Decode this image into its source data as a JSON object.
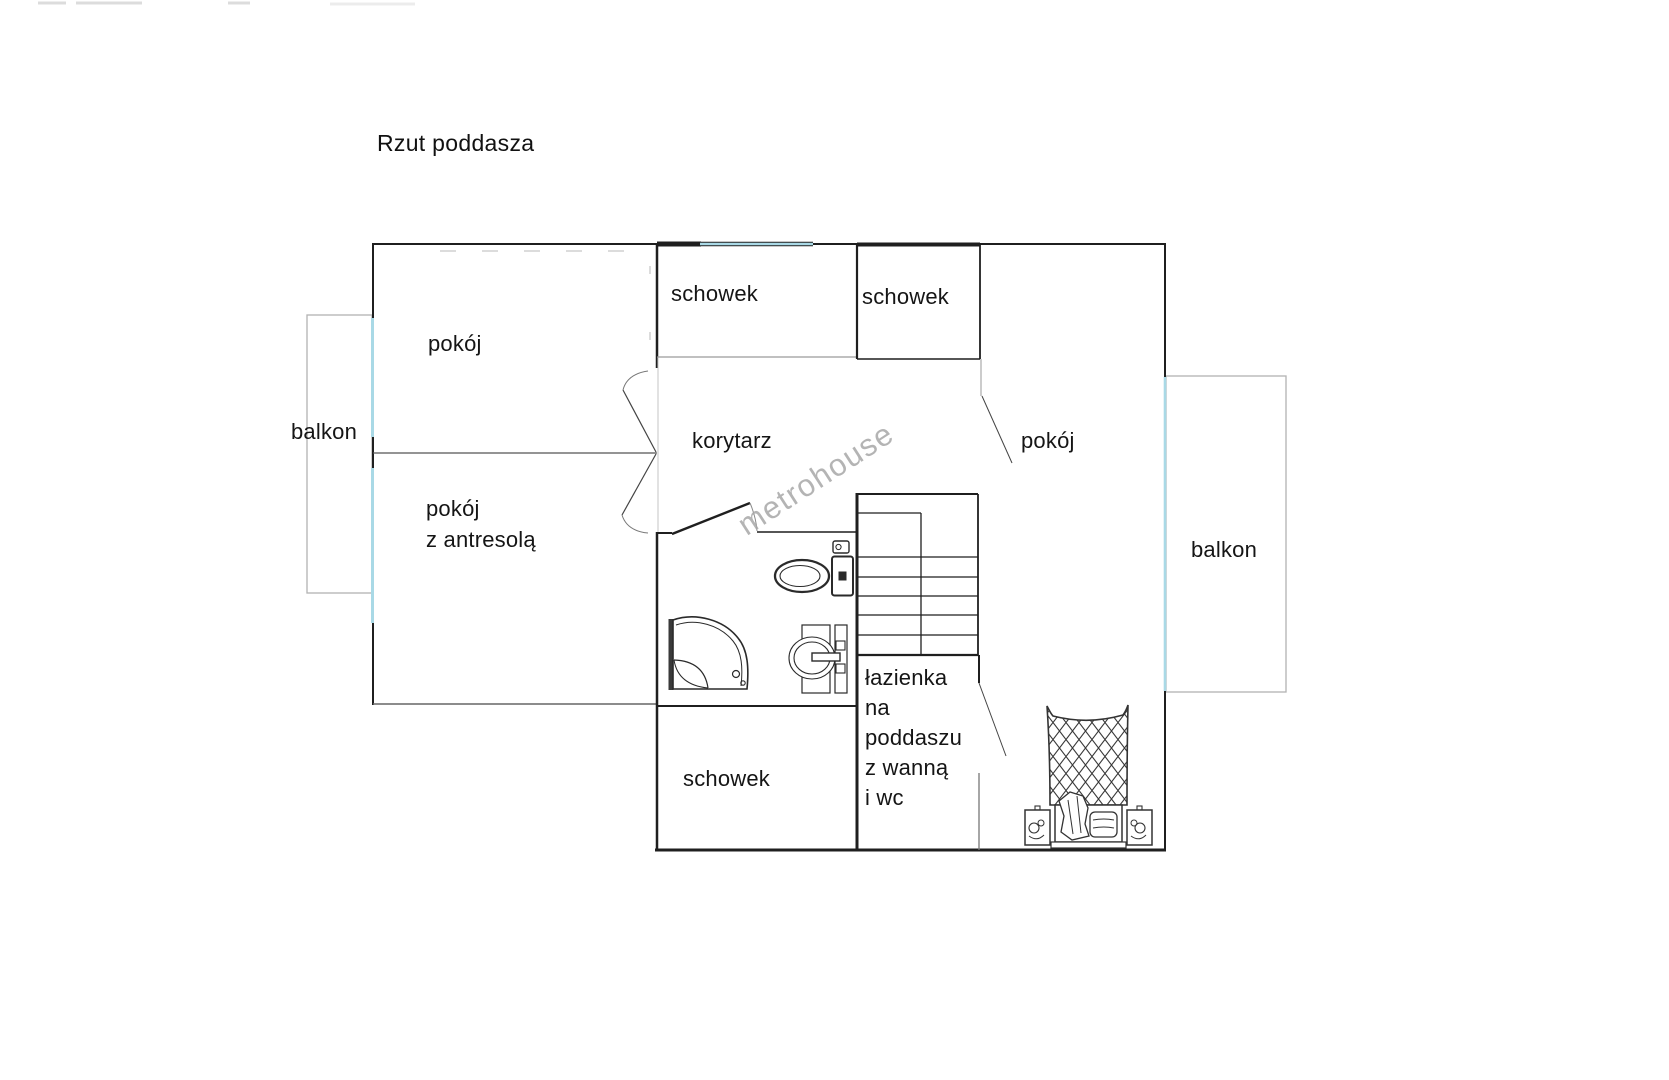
{
  "title": "Rzut poddasza",
  "watermark": "metrohouse",
  "rooms": {
    "pokoj_top_left": "pokój",
    "balkon_left": "balkon",
    "schowek_top_left": "schowek",
    "schowek_top_right": "schowek",
    "korytarz": "korytarz",
    "pokoj_right": "pokój",
    "pokoj_z_antresola_line1": "pokój",
    "pokoj_z_antresola_line2": "z antresolą",
    "balkon_right": "balkon",
    "schowek_bottom": "schowek",
    "lazienka_line1": "łazienka",
    "lazienka_line2": "na",
    "lazienka_line3": "poddaszu",
    "lazienka_line4": "z wanną",
    "lazienka_line5": "i wc"
  },
  "colors": {
    "wall": "#1f1f1f",
    "window_glass": "#a9d9e6",
    "balcony_outline": "#b2b2b2",
    "label_text": "#151515",
    "watermark_text": "#a8a8a8"
  },
  "fixture_icons": [
    "toilet-icon",
    "shower-icon",
    "sink-icon",
    "stairs-icon",
    "double-bed-icon",
    "nightstand-icon"
  ]
}
